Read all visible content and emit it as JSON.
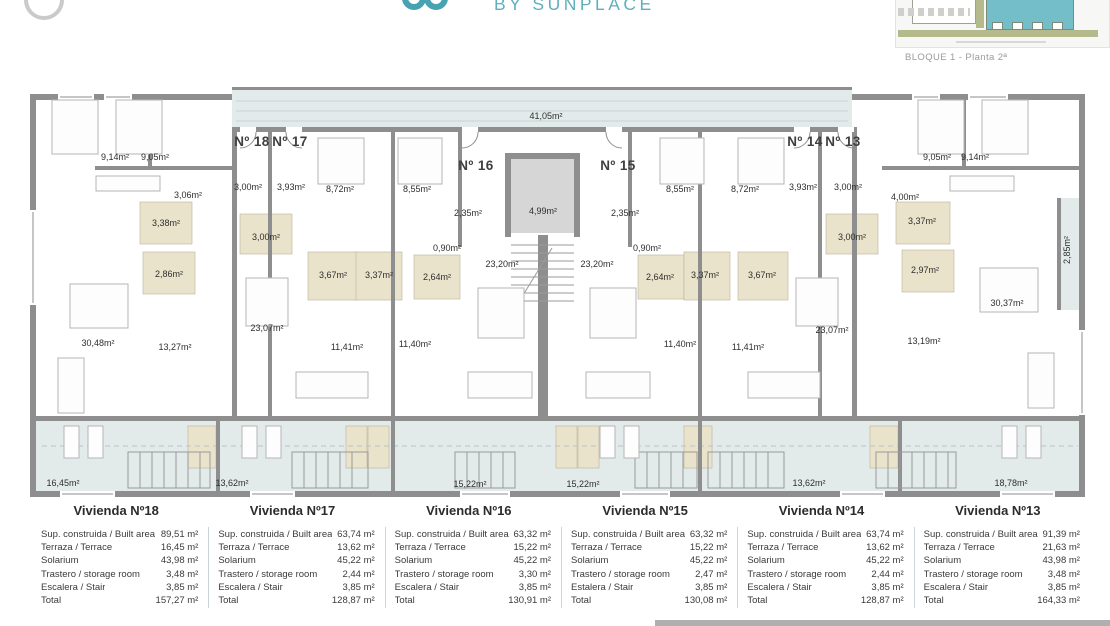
{
  "header": {
    "brand": "BY SUNPLACE",
    "site_thumbnail_caption": "BLOQUE 1 - Planta 2ª"
  },
  "colors": {
    "accent_teal": "#5fafbe",
    "wall_gray": "#8e8e8e",
    "terrace_fill": "#e2eaea",
    "bath_fill": "#eae3cb",
    "thumb_building_teal": "#74bec9",
    "thumb_green": "#b4ba8c"
  },
  "plan": {
    "apartments": [
      "Nº 18",
      "Nº 17",
      "Nº 16",
      "Nº 15",
      "Nº 14",
      "Nº 13"
    ],
    "labels": {
      "corridor": "41,05m²",
      "lift": "4,99m²",
      "b18a": "9,14m²",
      "b18b": "9,05m²",
      "h18": "3,06m²",
      "e18": "3,00m²",
      "w18a": "3,38m²",
      "w18b": "2,86m²",
      "l18": "30,48m²",
      "d18": "13,27m²",
      "t18": "16,45m²",
      "e17": "3,93m²",
      "bed17a": "8,72m²",
      "w17a": "3,00m²",
      "w17b": "3,67m²",
      "w17c": "3,37m²",
      "l17": "23,07m²",
      "bed17b": "11,41m²",
      "t17": "13,62m²",
      "bed16a": "8,55m²",
      "c16": "2,35m²",
      "h16": "0,90m²",
      "w16": "2,64m²",
      "k16": "23,20m²",
      "bed16b": "11,40m²",
      "t16": "15,22m²",
      "c15": "2,35m²",
      "h15": "0,90m²",
      "w15a": "2,64m²",
      "w15b": "3,37m²",
      "k15": "23,20m²",
      "bed15a": "8,55m²",
      "bed15b": "11,40m²",
      "t15": "15,22m²",
      "w14a": "3,00m²",
      "w14b": "3,67m²",
      "e14": "3,93m²",
      "bed14a": "8,72m²",
      "l14": "23,07m²",
      "bed14b": "11,41m²",
      "t14": "13,62m²",
      "e13": "3,00m²",
      "h13": "4,00m²",
      "b13a": "9,05m²",
      "b13b": "9,14m²",
      "w13a": "3,37m²",
      "w13b": "2,97m²",
      "l13": "30,37m²",
      "d13": "13,19m²",
      "t13": "18,78m²",
      "s13": "2,85m²"
    }
  },
  "table": {
    "columns": [
      {
        "title": "Vivienda Nº18",
        "rows": [
          {
            "label": "Sup. construida / Built area",
            "value": "89,51 m²"
          },
          {
            "label": "Terraza / Terrace",
            "value": "16,45 m²"
          },
          {
            "label": "Solarium",
            "value": "43,98 m²"
          },
          {
            "label": "Trastero / storage room",
            "value": "3,48 m²"
          },
          {
            "label": "Escalera / Stair",
            "value": "3,85 m²"
          },
          {
            "label": "Total",
            "value": "157,27 m²"
          }
        ]
      },
      {
        "title": "Vivienda Nº17",
        "rows": [
          {
            "label": "Sup. construida / Built area",
            "value": "63,74 m²"
          },
          {
            "label": "Terraza / Terrace",
            "value": "13,62 m²"
          },
          {
            "label": "Solarium",
            "value": "45,22 m²"
          },
          {
            "label": "Trastero / storage room",
            "value": "2,44 m²"
          },
          {
            "label": "Escalera / Stair",
            "value": "3,85 m²"
          },
          {
            "label": "Total",
            "value": "128,87 m²"
          }
        ]
      },
      {
        "title": "Vivienda Nº16",
        "rows": [
          {
            "label": "Sup. construida / Built area",
            "value": "63,32 m²"
          },
          {
            "label": "Terraza / Terrace",
            "value": "15,22 m²"
          },
          {
            "label": "Solarium",
            "value": "45,22 m²"
          },
          {
            "label": "Trastero / storage room",
            "value": "3,30 m²"
          },
          {
            "label": "Escalera / Stair",
            "value": "3,85 m²"
          },
          {
            "label": "Total",
            "value": "130,91 m²"
          }
        ]
      },
      {
        "title": "Vivienda Nº15",
        "rows": [
          {
            "label": "Sup. construida / Built area",
            "value": "63,32 m²"
          },
          {
            "label": "Terraza / Terrace",
            "value": "15,22 m²"
          },
          {
            "label": "Solarium",
            "value": "45,22 m²"
          },
          {
            "label": "Trastero / storage room",
            "value": "2,47 m²"
          },
          {
            "label": "Estalera / Stair",
            "value": "3,85 m²"
          },
          {
            "label": "Total",
            "value": "130,08 m²"
          }
        ]
      },
      {
        "title": "Vivienda Nº14",
        "rows": [
          {
            "label": "Sup. construida / Built area",
            "value": "63,74 m²"
          },
          {
            "label": "Terraza / Terrace",
            "value": "13,62 m²"
          },
          {
            "label": "Solarium",
            "value": "45,22 m²"
          },
          {
            "label": "Trastero / storage room",
            "value": "2,44 m²"
          },
          {
            "label": "Escalera / Stair",
            "value": "3,85 m²"
          },
          {
            "label": "Total",
            "value": "128,87 m²"
          }
        ]
      },
      {
        "title": "Vivienda Nº13",
        "rows": [
          {
            "label": "Sup. construida / Built area",
            "value": "91,39 m²"
          },
          {
            "label": "Terraza / Terrace",
            "value": "21,63 m²"
          },
          {
            "label": "Solarium",
            "value": "43,98 m²"
          },
          {
            "label": "Trastero / storage room",
            "value": "3,48 m²"
          },
          {
            "label": "Escalera / Stair",
            "value": "3,85 m²"
          },
          {
            "label": "Total",
            "value": "164,33 m²"
          }
        ]
      }
    ]
  }
}
